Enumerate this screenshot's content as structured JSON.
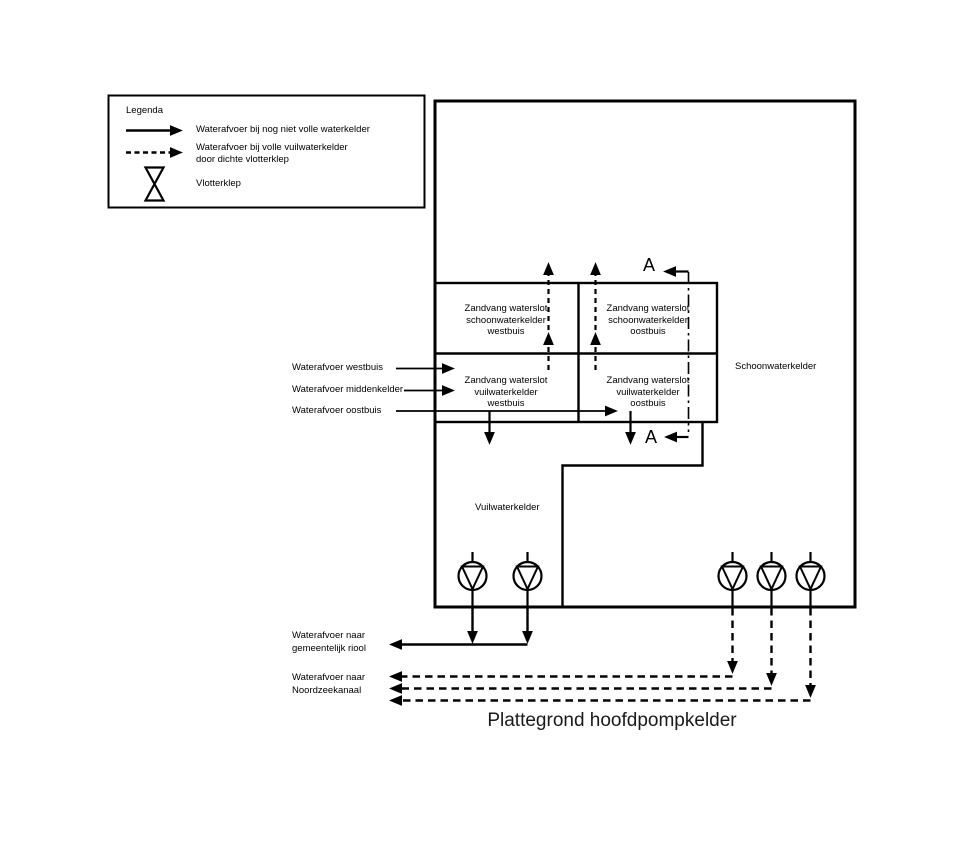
{
  "title": "Plattegrond hoofdpompkelder",
  "legend": {
    "title": "Legenda",
    "items": [
      {
        "symbol": "solid-arrow",
        "label": "Waterafvoer bij nog niet volle waterkelder"
      },
      {
        "symbol": "dashed-arrow",
        "label": "Waterafvoer bij volle vuilwaterkelder\ndoor dichte vlotterklep"
      },
      {
        "symbol": "float-valve",
        "label": "Vlotterklep"
      }
    ]
  },
  "compartments": {
    "schoonwater_westbuis": "Zandvang waterslot\nschoonwaterkelder\nwestbuis",
    "schoonwater_oostbuis": "Zandvang waterslot\nschoonwaterkelder\noostbuis",
    "vuilwater_westbuis": "Zandvang waterslot\nvuilwaterkelder\nwestbuis",
    "vuilwater_oostbuis": "Zandvang waterslot\nvuilwaterkelder\noostbuis"
  },
  "regions": {
    "schoonwaterkelder": "Schoonwaterkelder",
    "vuilwaterkelder": "Vuilwaterkelder"
  },
  "inflows": [
    "Waterafvoer westbuis",
    "Waterafvoer middenkelder",
    "Waterafvoer oostbuis"
  ],
  "outflows": {
    "riool": "Waterafvoer naar\ngemeentelijk riool",
    "noordzeekanaal": "Waterafvoer naar\nNoordzeekanaal"
  },
  "section_marker": "A",
  "colors": {
    "line": "#000000",
    "background": "#ffffff"
  }
}
